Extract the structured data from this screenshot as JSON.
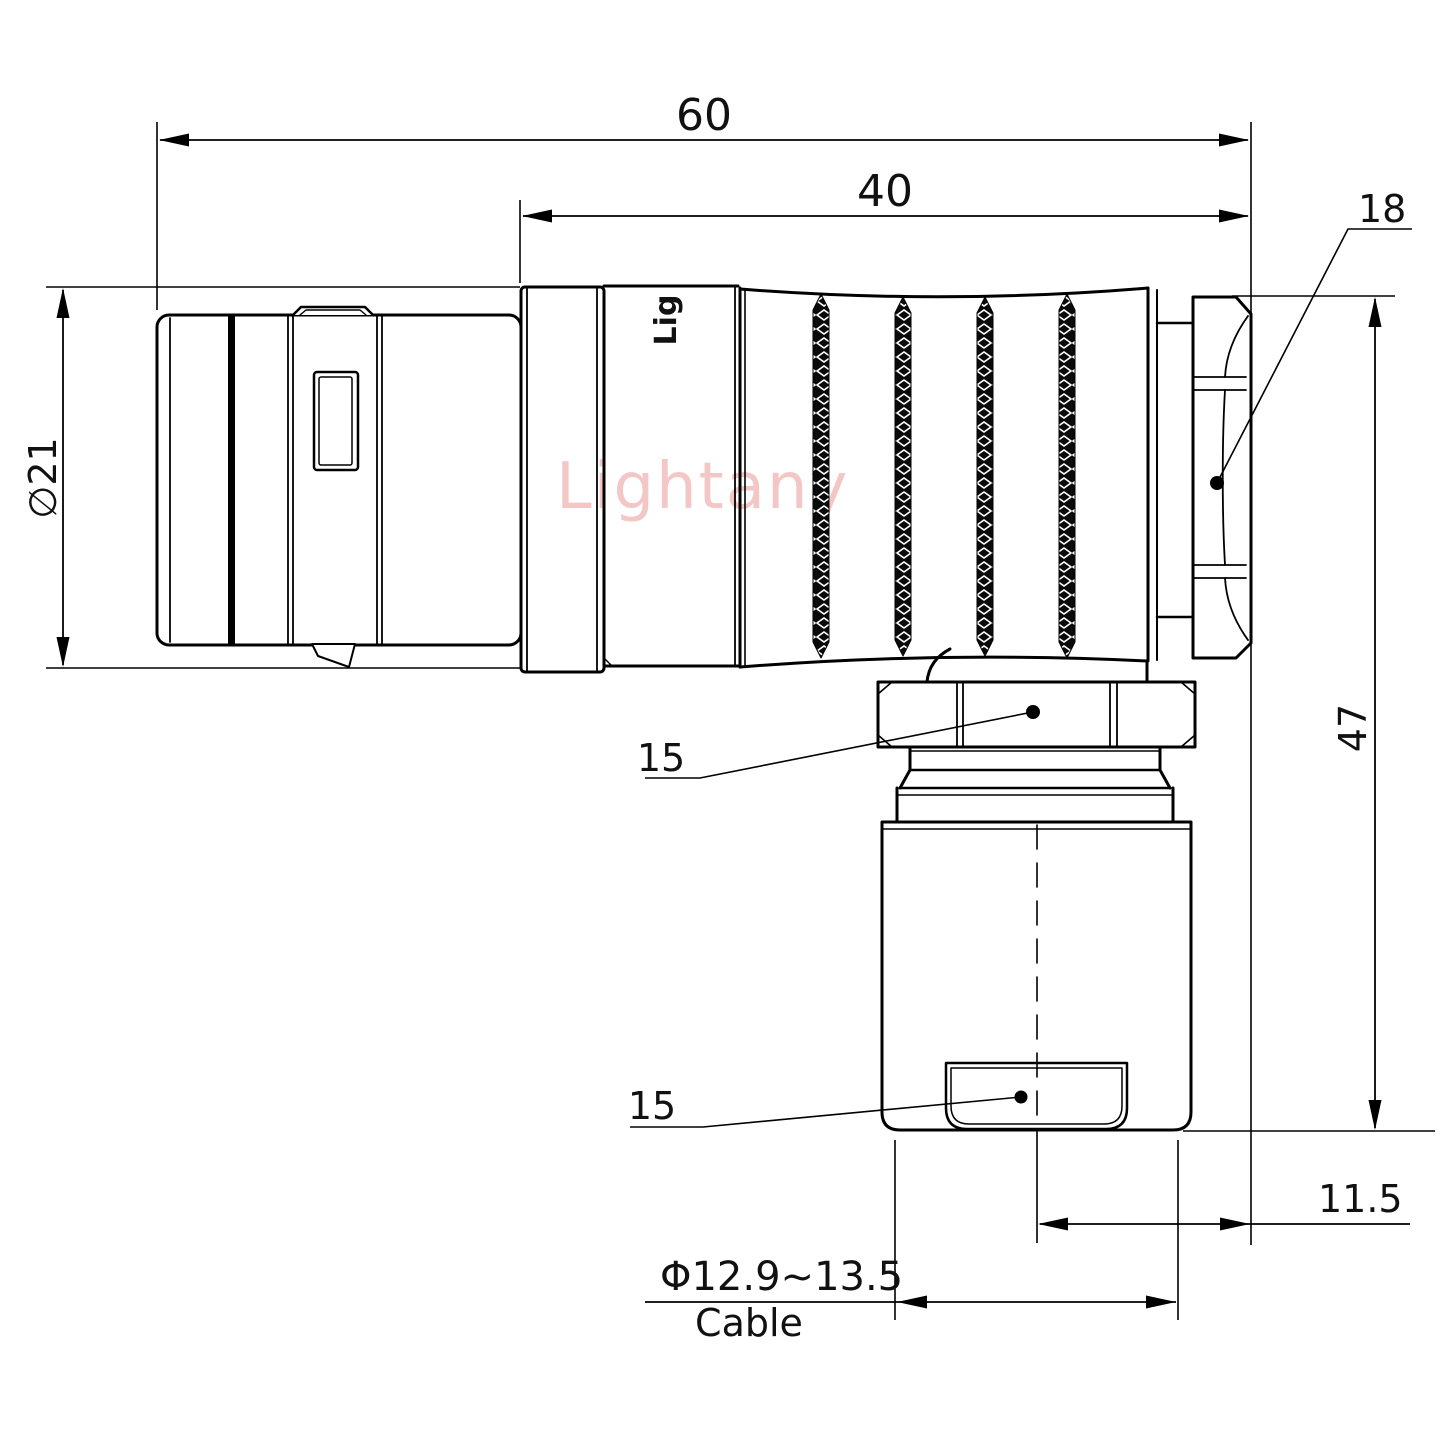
{
  "drawing": {
    "watermark": "Lightany",
    "body_engraving": "Lig",
    "labels": {
      "overall_length": "60",
      "front_section_length": "40",
      "backnut_across_flats": "18",
      "shell_diameter": "∅21",
      "overall_height": "47",
      "coupling_nut_flats": "15",
      "gland_flats": "15",
      "exit_offset": "11.5",
      "cable_diameter_range": "Φ12.9~13.5",
      "cable_label": "Cable"
    }
  }
}
